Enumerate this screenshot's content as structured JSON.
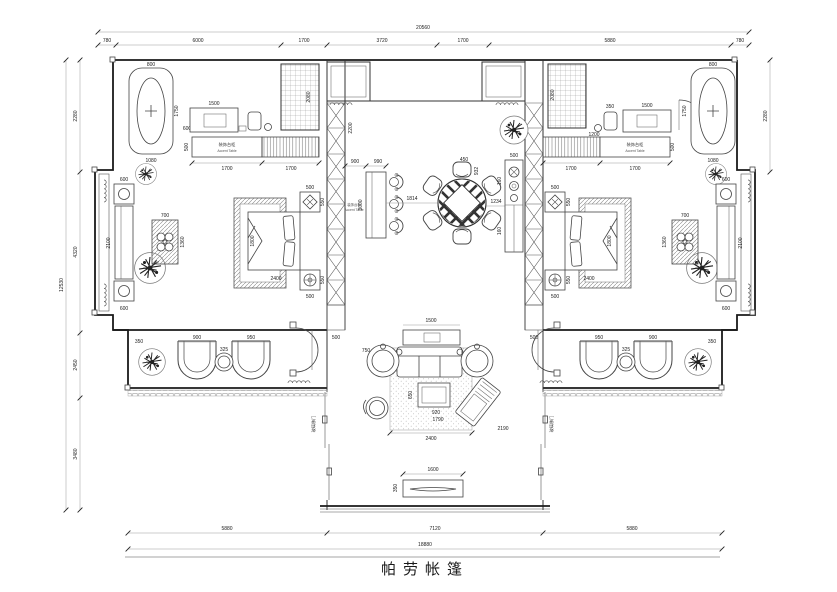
{
  "title": "帕劳帐篷",
  "dims_top": {
    "total": "20560",
    "segments": [
      "780",
      "6000",
      "1700",
      "3720",
      "1700",
      "5880",
      "780"
    ]
  },
  "dims_bottom": {
    "total": "18880",
    "segments": [
      "5880",
      "7120",
      "5880"
    ]
  },
  "dims_left": {
    "total": "12530",
    "segments": [
      "2280",
      "4320",
      "2450",
      "3480"
    ]
  },
  "dims_right": {
    "segments": [
      "2280"
    ]
  },
  "labels": {
    "cabinet_left_zh": "装饰台柜",
    "cabinet_left_en": "Accent Table",
    "cabinet_right_zh": "装饰台柜",
    "cabinet_right_en": "Accent Table",
    "console_zh": "装饰台柜",
    "console_en": "Accent Table",
    "door_left": "玻璃移门",
    "door_right": "玻璃移门"
  },
  "fd": {
    "l_tub_w": "800",
    "l_tub_len": "1750",
    "l_tub_b": "1080",
    "l_tub_gap": "600",
    "l_dresser": "1500",
    "l_shower_h": "2080",
    "l_row_d": "500",
    "l_cab1": "1700",
    "l_cab2": "1700",
    "l_ns_t_w": "500",
    "l_ns_t_d": "550",
    "l_ns_b_w": "500",
    "l_ns_b_d": "550",
    "l_bed_w": "1800",
    "l_bed_len": "2400",
    "l_lat_w": "500",
    "l_lat_h": "2200",
    "l_bay_t1": "600",
    "l_bay_sofa": "2100",
    "l_bay_t2": "600",
    "l_sq_w": "700",
    "l_sq_h": "1360",
    "l_chair1": "900",
    "l_chair2": "950",
    "l_table": "325",
    "l_plant": "350",
    "c_con_a": "900",
    "c_con_b": "990",
    "c_con_h": "3000",
    "c_gap": "1814",
    "c_chair": "450",
    "c_chair_d": "932",
    "c_right": "1234",
    "c_160a": "160",
    "c_160b": "160",
    "c_rcon_w": "500",
    "r_lat_w": "500",
    "v_back": "1500",
    "v_back_d": "900",
    "v_chair": "750",
    "v_side": "650",
    "v_coffee_w": "920",
    "v_coffee_l": "1790",
    "v_chaise": "2190",
    "v_rug": "2400",
    "v_bench": "1600",
    "v_bench_d": "350",
    "r_shower_h": "2080",
    "r_shower_w": "1200",
    "r_stool": "350",
    "r_dresser": "1500",
    "r_row_d": "500",
    "r_cab1": "1700",
    "r_cab2": "1700",
    "r_ns_t_w": "500",
    "r_ns_t_d": "550",
    "r_ns_b_w": "500",
    "r_ns_b_d": "550",
    "r_bed_w": "1800",
    "r_bed_len": "2400",
    "r_tub_w": "800",
    "r_tub_len": "1750",
    "r_tub_b": "1080",
    "r_bay_t1": "600",
    "r_bay_sofa": "2100",
    "r_bay_t2": "600",
    "r_sq_w": "700",
    "r_sq_h": "1360",
    "r_chair1": "950",
    "r_chair2": "900",
    "r_table": "325",
    "r_plant": "350"
  }
}
